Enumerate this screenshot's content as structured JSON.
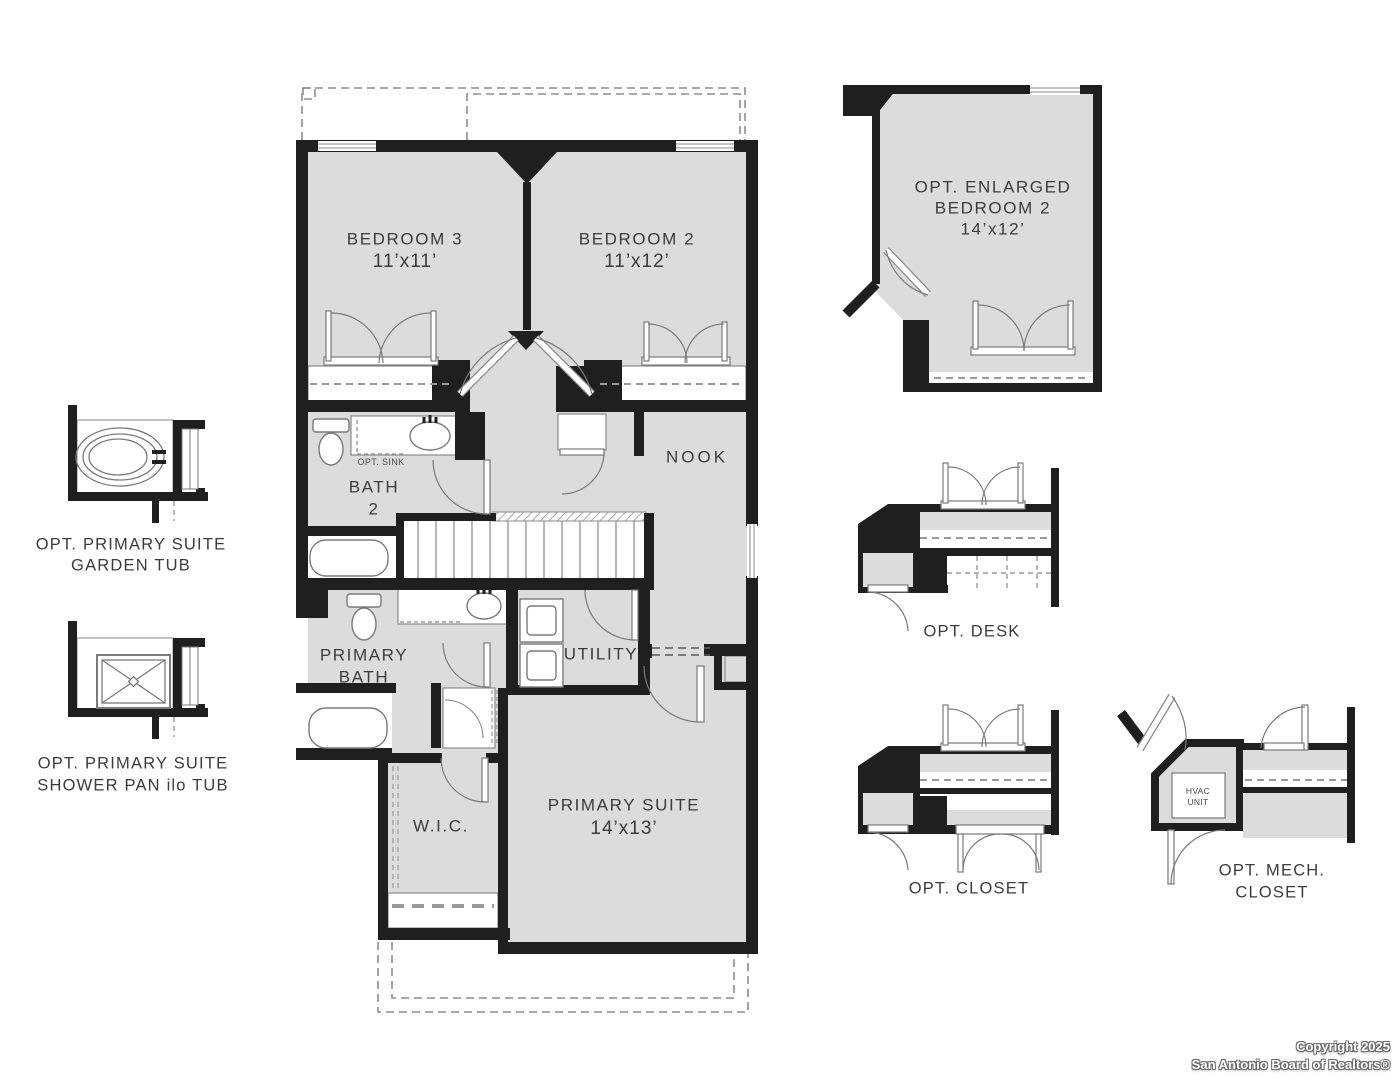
{
  "colors": {
    "wall": "#1f1f1f",
    "room_fill": "#dcdcdc",
    "fixture_line": "#7a7a7a",
    "dash_line": "#9a9a9a",
    "label_text": "#3c3c3c"
  },
  "plan": {
    "rooms": {
      "bedroom3": {
        "name": "BEDROOM 3",
        "dims": "11’x11’"
      },
      "bedroom2": {
        "name": "BEDROOM 2",
        "dims": "11’x12’"
      },
      "nook": {
        "name": "NOOK"
      },
      "bath2": {
        "line1": "BATH",
        "line2": "2"
      },
      "opt_sink": {
        "name": "OPT. SINK"
      },
      "primary_bath": {
        "line1": "PRIMARY",
        "line2": "BATH"
      },
      "utility": {
        "name": "UTILITY"
      },
      "wic": {
        "name": "W.I.C."
      },
      "primary_suite": {
        "name": "PRIMARY SUITE",
        "dims": "14’x13’"
      }
    },
    "options": {
      "garden_tub": {
        "line1": "OPT. PRIMARY SUITE",
        "line2": "GARDEN TUB"
      },
      "shower_pan": {
        "line1": "OPT. PRIMARY SUITE",
        "line2": "SHOWER PAN ilo TUB"
      },
      "enlarged_bedroom2": {
        "line1": "OPT. ENLARGED",
        "line2": "BEDROOM 2",
        "dims": "14’x12’"
      },
      "desk": {
        "name": "OPT. DESK"
      },
      "closet": {
        "name": "OPT. CLOSET"
      },
      "mech_closet": {
        "line1": "OPT. MECH.",
        "line2": "CLOSET"
      },
      "hvac": {
        "line1": "HVAC",
        "line2": "UNIT"
      }
    }
  },
  "footer": {
    "line1": "Copyright 2025",
    "line2": "San Antonio Board of Realtors®"
  }
}
